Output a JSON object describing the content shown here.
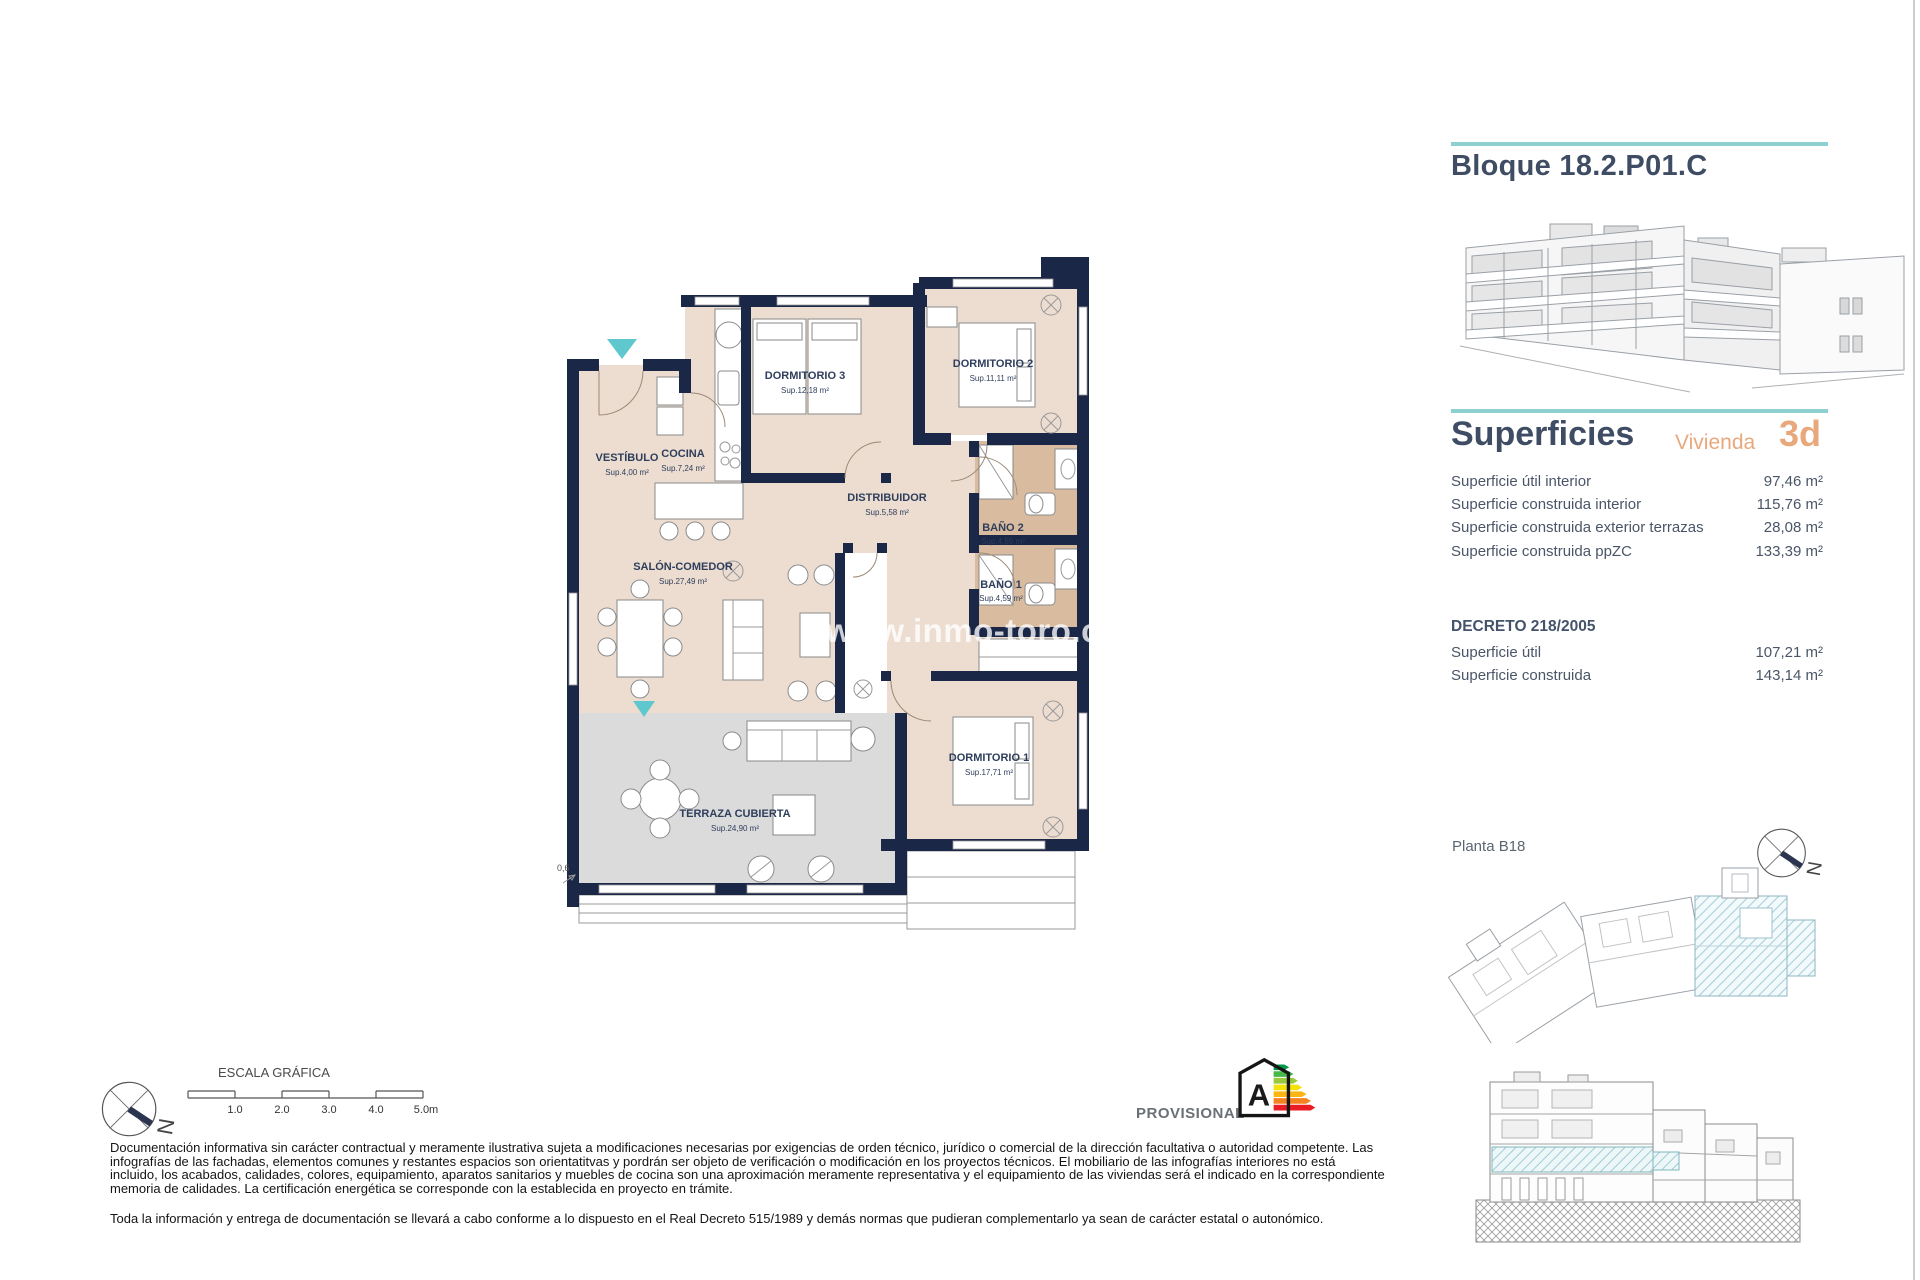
{
  "document": {
    "block_title": "Bloque 18.2.P01.C",
    "watermark": "www.inmo-toro.com"
  },
  "superficies": {
    "title": "Superficies",
    "vivienda_label": "Vivienda",
    "vivienda_code": "3d",
    "rows": [
      {
        "label": "Superficie útil interior",
        "value": "97,46 m²"
      },
      {
        "label": "Superficie construida interior",
        "value": "115,76 m²"
      },
      {
        "label": "Superficie construida exterior terrazas",
        "value": "28,08 m²"
      },
      {
        "label": "Superficie construida ppZC",
        "value": "133,39 m²"
      }
    ],
    "decreto_title": "DECRETO 218/2005",
    "decreto_rows": [
      {
        "label": "Superficie útil",
        "value": "107,21 m²"
      },
      {
        "label": "Superficie construida",
        "value": "143,14 m²"
      }
    ]
  },
  "siteplan": {
    "label": "Planta B18"
  },
  "compass": {
    "n": "N"
  },
  "plan": {
    "rooms": {
      "vestibulo": {
        "name": "VESTÍBULO",
        "sup": "Sup.4,00 m²"
      },
      "cocina": {
        "name": "COCINA",
        "sup": "Sup.7,24 m²"
      },
      "dormitorio3": {
        "name": "DORMITORIO 3",
        "sup": "Sup.12,18 m²"
      },
      "dormitorio2": {
        "name": "DORMITORIO 2",
        "sup": "Sup.11,11 m²"
      },
      "distribuidor": {
        "name": "DISTRIBUIDOR",
        "sup": "Sup.5,58 m²"
      },
      "bano2": {
        "name": "BAÑO 2",
        "sup": "Sup.4,59 m²"
      },
      "bano1": {
        "name": "BAÑO 1",
        "sup": "Sup.4,59 m²"
      },
      "salon": {
        "name": "SALÓN-COMEDOR",
        "sup": "Sup.27,49 m²"
      },
      "terraza": {
        "name": "TERRAZA CUBIERTA",
        "sup": "Sup.24,90 m²"
      },
      "dormitorio1": {
        "name": "DORMITORIO 1",
        "sup": "Sup.17,71 m²"
      }
    },
    "dimension": "0,6"
  },
  "footer": {
    "escala_title": "ESCALA GRÁFICA",
    "scale_ticks": [
      "1.0",
      "2.0",
      "3.0",
      "4.0",
      "5.0m"
    ],
    "provisional": "PROVISIONAL",
    "energy_letter": "A",
    "disclaimer_p1": "Documentación informativa sin carácter contractual y meramente ilustrativa sujeta a modificaciones necesarias por exigencias de orden técnico, jurídico o comercial de la dirección facultativa o autoridad competente. Las infografías de las fachadas, elementos comunes y restantes espacios son orientatitvas y pordrán ser objeto de verificación o modificación en los proyectos técnicos. El mobiliario de las infografías interiores no está incluido, los acabados, calidades, colores, equipamiento, aparatos sanitarios y muebles de cocina son una aproximación meramente representativa y el equipamiento de las viviendas será el indicado en la correspondiente memoria de calidades. La certificación energética se corresponde con la establecida en proyecto en trámite.",
    "disclaimer_p2": "Toda la información y entrega de documentación se llevará a cabo conforme a lo dispuesto en el Real Decreto 515/1989 y demás normas que pudieran complementarlo ya sean de carácter estatal o autonómico."
  },
  "colors": {
    "accent_teal": "#8ed0cf",
    "accent_orange": "#e9a87c",
    "heading": "#3e4d63",
    "wall_navy": "#1b2747",
    "room_beige": "#ecddd0",
    "bath_tan": "#d9bc9f",
    "terrace_gray": "#dbdbdb",
    "entry_marker_teal": "#5fc8ce"
  }
}
